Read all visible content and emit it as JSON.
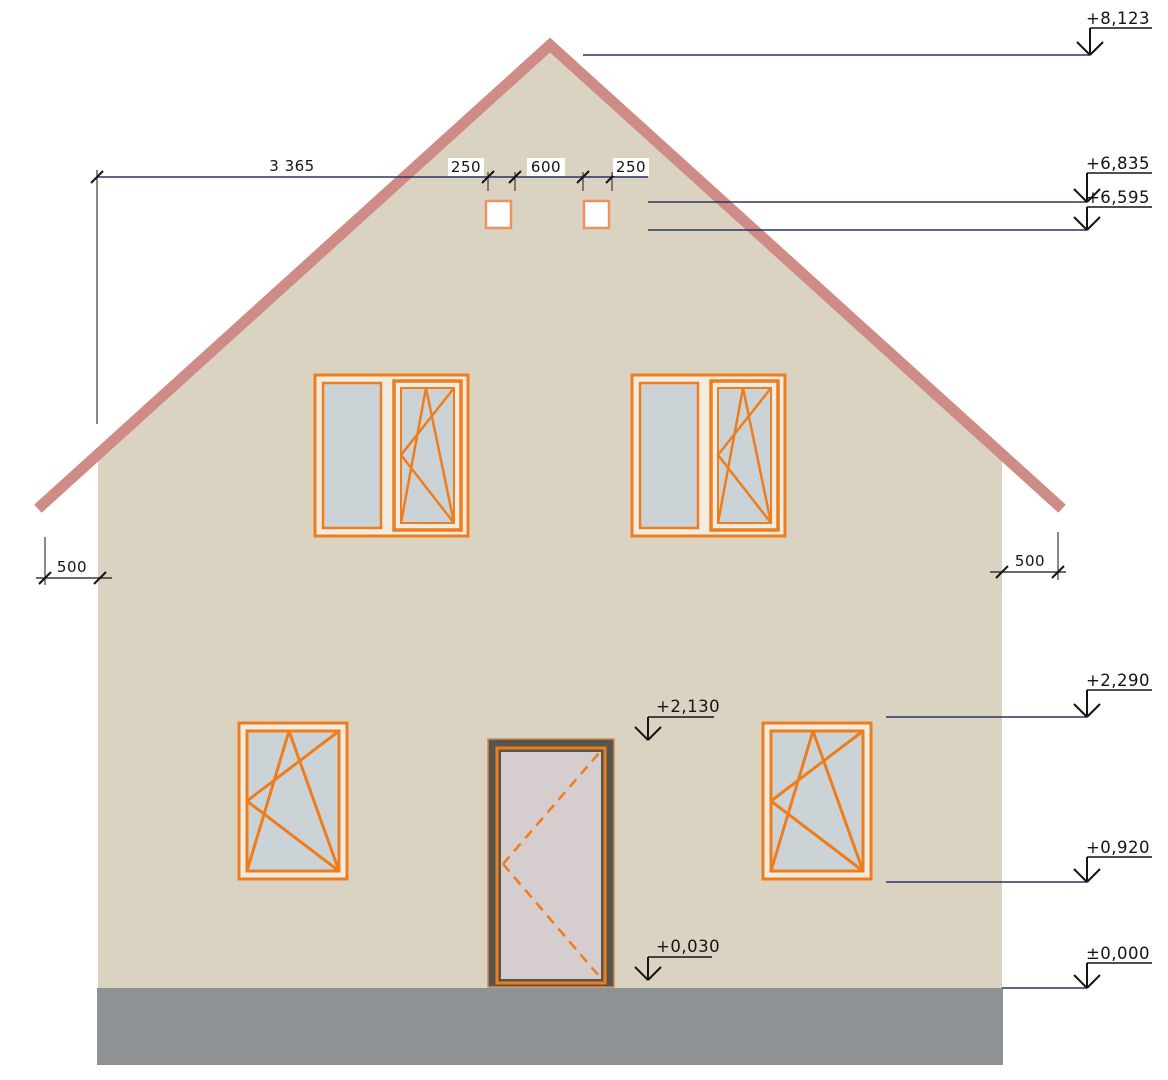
{
  "drawing": {
    "kind": "house-front-elevation"
  },
  "levels": {
    "ridge": "+8,123",
    "attic_window_top": "+6,835",
    "attic_window_bottom": "+6,595",
    "window_head": "+2,290",
    "window_sill": "+0,920",
    "ground": "±0,000",
    "door_head": "+2,130",
    "door_threshold": "+0,030"
  },
  "dimensions": {
    "overall_width": "3 365",
    "attic_window_left": "250",
    "attic_gap": "600",
    "attic_window_right": "250",
    "overhang_left": "500",
    "overhang_right": "500"
  },
  "colors": {
    "wall": "#dbd3c2",
    "frame_gap": "#f1ecdf",
    "roof": "#cf8b85",
    "foundation": "#8e9295",
    "window_frame": "#ee7d1e",
    "glass": "#ccd3d6",
    "small_window_frame": "#f0915f",
    "small_window_fill": "#ffffff",
    "door_frame": "#57564d",
    "door_frame_edge": "#cf8b50",
    "door_panel": "#d6cdce",
    "leader": "#2c3362",
    "ink": "#141414"
  }
}
